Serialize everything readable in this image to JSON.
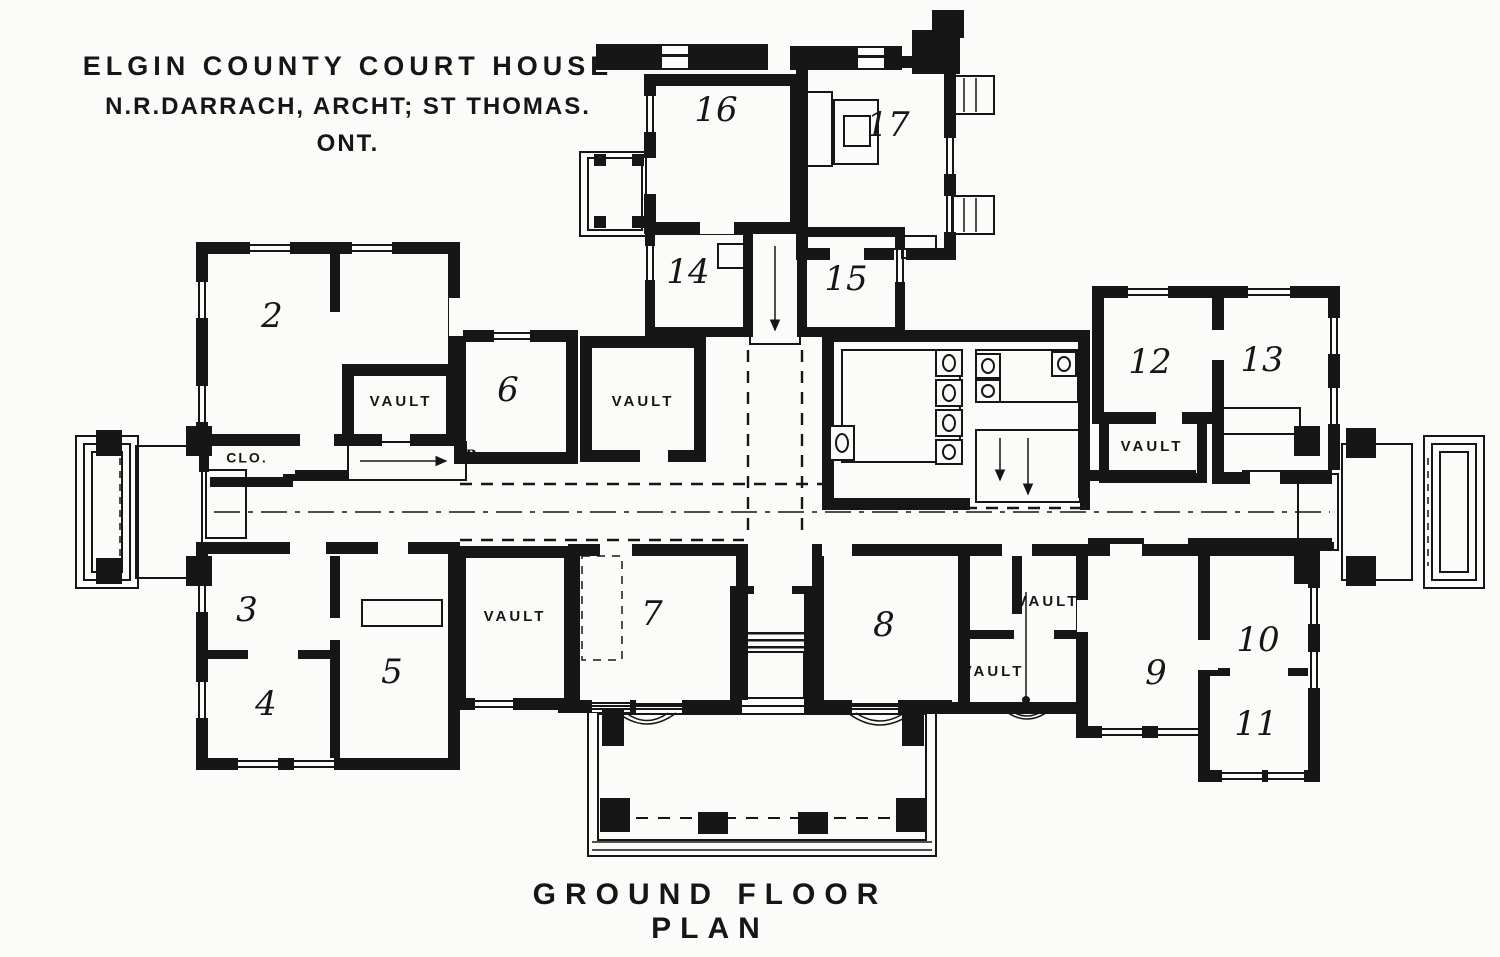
{
  "title": {
    "line1": "ELGIN COUNTY COURT HOUSE",
    "line2": "N.R.DARRACH, ARCHT; ST THOMAS. ONT."
  },
  "caption": "GROUND FLOOR PLAN",
  "labels": {
    "vault": "VAULT",
    "closet": "CLO.",
    "up": "UP"
  },
  "rooms": {
    "r2": "2",
    "r3": "3",
    "r4": "4",
    "r5": "5",
    "r6": "6",
    "r7": "7",
    "r8": "8",
    "r9": "9",
    "r10": "10",
    "r11": "11",
    "r12": "12",
    "r13": "13",
    "r14": "14",
    "r15": "15",
    "r16": "16",
    "r17": "17"
  },
  "colors": {
    "ink": "#161616",
    "paper": "#fbfbf9"
  }
}
